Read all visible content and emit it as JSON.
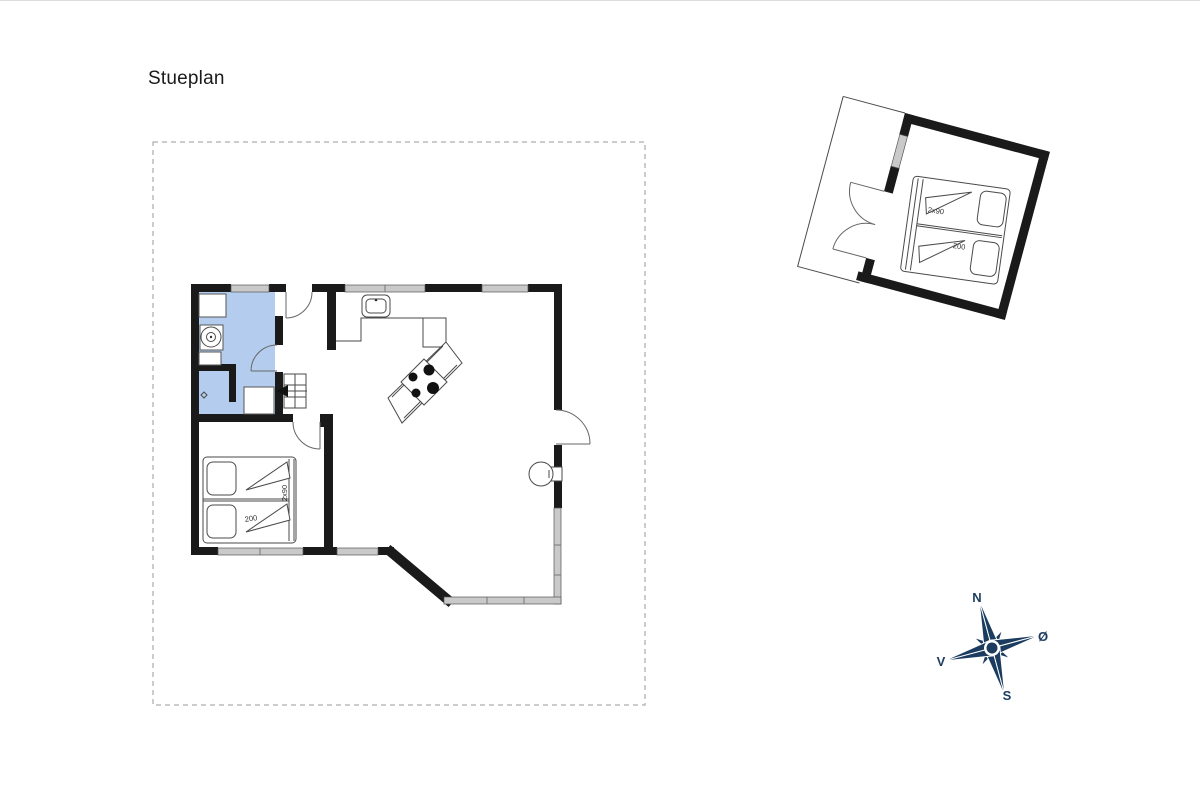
{
  "title": "Stueplan",
  "plan": {
    "main_bed": {
      "width_label": "2x90",
      "length_label": "200"
    },
    "annexe_bed": {
      "width_label": "2x90",
      "length_label": "200"
    }
  },
  "compass": {
    "north": "N",
    "east": "Ø",
    "south": "S",
    "west": "V"
  },
  "icons": [
    "compass-rose-icon",
    "sink-icon",
    "stove-hob-icon",
    "washbasin-icon",
    "toilet-icon",
    "shower-drain-icon",
    "stairs-icon",
    "wood-stove-icon",
    "double-bed-icon",
    "door-arc-icon"
  ],
  "colors": {
    "wall": "#1a1a1a",
    "window": "#c9c9c9",
    "bathroom": "#b4cdee",
    "compass": "#1c3c5f",
    "line": "#4a4a4a"
  }
}
